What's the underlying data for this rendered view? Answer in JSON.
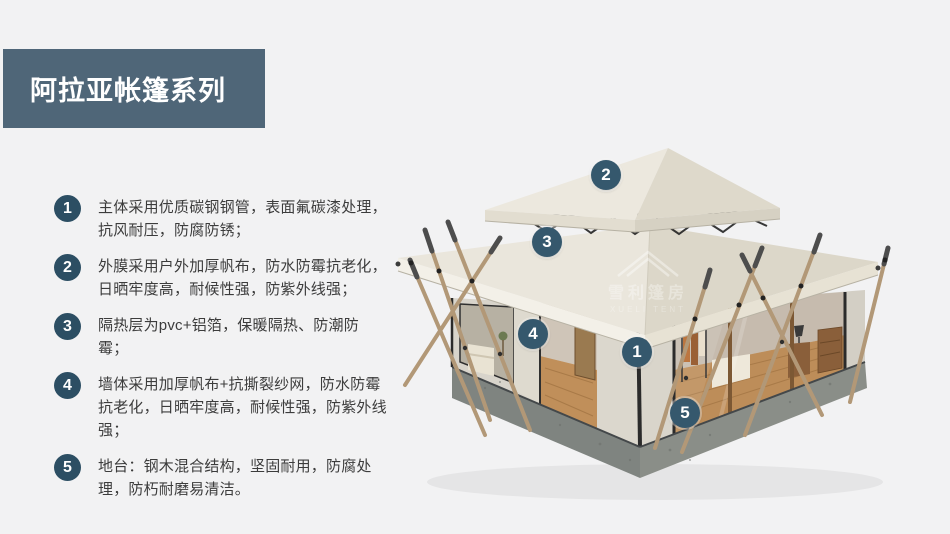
{
  "header": {
    "title": "阿拉亚帐篷系列"
  },
  "features": [
    {
      "num": "1",
      "text": "主体采用优质碳钢钢管，表面氟碳漆处理，抗风耐压，防腐防锈；"
    },
    {
      "num": "2",
      "text": "外膜采用户外加厚帆布，防水防霉抗老化，日晒牢度高，耐候性强，防紫外线强；"
    },
    {
      "num": "3",
      "text": "隔热层为pvc+铝箔，保暖隔热、防潮防霉；"
    },
    {
      "num": "4",
      "text": "墙体采用加厚帆布+抗撕裂纱网，防水防霉抗老化，日晒牢度高，耐候性强，防紫外线强；"
    },
    {
      "num": "5",
      "text": "地台：钢木混合结构，坚固耐用，防腐处理，防朽耐磨易清洁。"
    }
  ],
  "tent_markers": [
    {
      "label": "1"
    },
    {
      "label": "2"
    },
    {
      "label": "3"
    },
    {
      "label": "4"
    },
    {
      "label": "5"
    }
  ],
  "watermark": {
    "cn": "雪利篷房",
    "en": "XUELI TENT"
  },
  "colors": {
    "background": "#f2f2f3",
    "title_bg": "#4f6678",
    "badge_bg": "#2c4e63",
    "marker_bg": "#35586d",
    "canvas_light": "#ece8de",
    "canvas_dark": "#dcd7c9",
    "plinth_gray": "#8a8e88",
    "pole_wood": "#b29877"
  }
}
